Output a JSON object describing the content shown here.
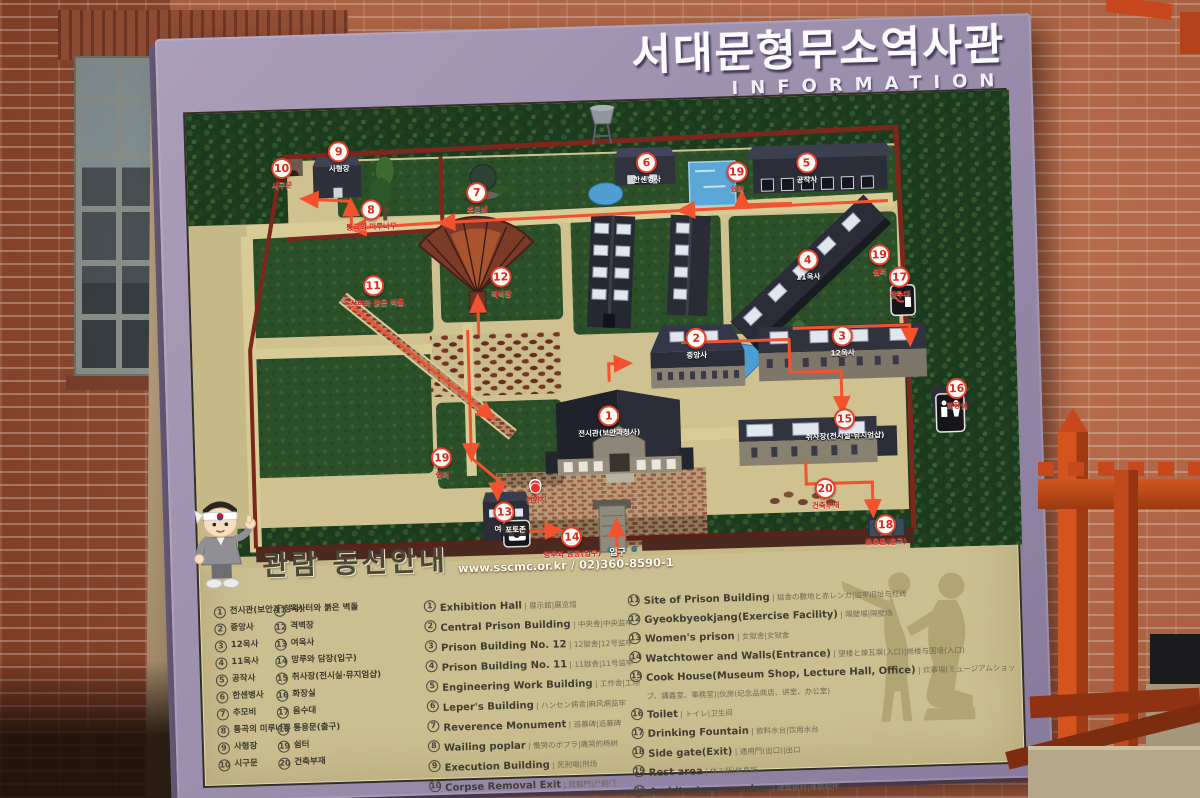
{
  "board": {
    "title_ko": "서대문형무소역사관",
    "title_en": "INFORMATION",
    "guide_title": "관람 동선안내",
    "guide_contact": "www.sscmc.or.kr / 02)360-8590-1"
  },
  "colors": {
    "frame_purple": "#9c8fae",
    "panel_beige": "#cbbe90",
    "route_red": "#f4512e",
    "boundary_wall_red": "#7c261c",
    "tree_green": "#1c3a1e",
    "fence_orange": "#c8481e",
    "marker_ring_red": "#e8402a"
  },
  "map": {
    "markers": [
      {
        "n": "1",
        "label": "전시관(보안과청사)",
        "x": 50.3,
        "y": 70.3,
        "on": "dark"
      },
      {
        "n": "2",
        "label": "중앙사",
        "x": 61.2,
        "y": 53.8,
        "on": "dark"
      },
      {
        "n": "3",
        "label": "12옥사",
        "x": 78.9,
        "y": 54.3,
        "on": "dark"
      },
      {
        "n": "4",
        "label": "11옥사",
        "x": 75.0,
        "y": 37.4,
        "on": "dark"
      },
      {
        "n": "5",
        "label": "공작사",
        "x": 75.2,
        "y": 16.0,
        "on": "dark"
      },
      {
        "n": "6",
        "label": "한센병사",
        "x": 55.8,
        "y": 14.9,
        "on": "dark"
      },
      {
        "n": "7",
        "label": "추모비",
        "x": 35.1,
        "y": 20.4,
        "on": "light"
      },
      {
        "n": "8",
        "label": "통곡의 미루나무",
        "x": 22.2,
        "y": 23.5,
        "on": "light"
      },
      {
        "n": "9",
        "label": "사형장",
        "x": 18.5,
        "y": 10.5,
        "on": "dark"
      },
      {
        "n": "10",
        "label": "시구문",
        "x": 11.5,
        "y": 13.8,
        "on": "light"
      },
      {
        "n": "11",
        "label": "옥사터와 붉은 벽돌",
        "x": 22.2,
        "y": 40.2,
        "on": "light"
      },
      {
        "n": "12",
        "label": "격벽장",
        "x": 37.7,
        "y": 39.1,
        "on": "light"
      },
      {
        "n": "13",
        "label": "여옥사",
        "x": 37.3,
        "y": 90.8,
        "on": "dark"
      },
      {
        "n": "14",
        "label": "망루와 담장(입구)",
        "x": 45.4,
        "y": 96.7,
        "on": "light"
      },
      {
        "n": "15",
        "label": "취사장(전시실·뮤지엄샵)",
        "x": 78.9,
        "y": 72.5,
        "on": "dark"
      },
      {
        "n": "16",
        "label": "화장실",
        "x": 92.6,
        "y": 66.6,
        "on": "light"
      },
      {
        "n": "17",
        "label": "음수대",
        "x": 86.1,
        "y": 41.8,
        "on": "light"
      },
      {
        "n": "18",
        "label": "통용문(출구)",
        "x": 83.5,
        "y": 96.0,
        "on": "light"
      },
      {
        "n": "19",
        "label": "쉼터",
        "x": 66.7,
        "y": 17.6,
        "on": "light"
      },
      {
        "n": "19",
        "label": "쉼터",
        "x": 83.7,
        "y": 36.7,
        "on": "light"
      },
      {
        "n": "19",
        "label": "쉼터",
        "x": 29.9,
        "y": 78.5,
        "on": "light"
      },
      {
        "n": "20",
        "label": "건축부재",
        "x": 76.3,
        "y": 87.7,
        "on": "light"
      }
    ],
    "tags": [
      {
        "label": "현위치",
        "x": 41.2,
        "y": 85.7,
        "type": "dot"
      },
      {
        "label": "포토존",
        "x": 38.6,
        "y": 93.5,
        "type": "photo"
      },
      {
        "label": "입구",
        "x": 50.9,
        "y": 99.0,
        "type": "plain"
      }
    ]
  },
  "legend": {
    "ko_col1": [
      {
        "n": "1",
        "t": "전시관(보안과 청사)"
      },
      {
        "n": "2",
        "t": "중앙사"
      },
      {
        "n": "3",
        "t": "12옥사"
      },
      {
        "n": "4",
        "t": "11옥사"
      },
      {
        "n": "5",
        "t": "공작사"
      },
      {
        "n": "6",
        "t": "한센병사"
      },
      {
        "n": "7",
        "t": "추모비"
      },
      {
        "n": "8",
        "t": "통곡의 미루나무"
      },
      {
        "n": "9",
        "t": "사형장"
      },
      {
        "n": "10",
        "t": "시구문"
      }
    ],
    "ko_col2": [
      {
        "n": "11",
        "t": "옥사터와 붉은 벽돌"
      },
      {
        "n": "12",
        "t": "격벽장"
      },
      {
        "n": "13",
        "t": "여옥사"
      },
      {
        "n": "14",
        "t": "망루와 담장(입구)"
      },
      {
        "n": "15",
        "t": "취사장(전시실·뮤지엄샵)"
      },
      {
        "n": "16",
        "t": "화장실"
      },
      {
        "n": "17",
        "t": "음수대"
      },
      {
        "n": "18",
        "t": "통용문(출구)"
      },
      {
        "n": "19",
        "t": "쉼터"
      },
      {
        "n": "20",
        "t": "건축부재"
      }
    ],
    "en_col1": [
      {
        "n": "1",
        "en": "Exhibition Hall",
        "cjk": "展示館|展览馆"
      },
      {
        "n": "2",
        "en": "Central Prison Building",
        "cjk": "中央舎|中央监牢"
      },
      {
        "n": "3",
        "en": "Prison Building No. 12",
        "cjk": "12獄舎|12号监牢"
      },
      {
        "n": "4",
        "en": "Prison Building No. 11",
        "cjk": "11獄舎|11号监牢"
      },
      {
        "n": "5",
        "en": "Engineering Work Building",
        "cjk": "工作舎|工场"
      },
      {
        "n": "6",
        "en": "Leper's Building",
        "cjk": "ハンセン病舎|麻风病监牢"
      },
      {
        "n": "7",
        "en": "Reverence Monument",
        "cjk": "追慕碑|追慕碑"
      },
      {
        "n": "8",
        "en": "Wailing poplar",
        "cjk": "慟哭のポプラ|痛哭的杨树"
      },
      {
        "n": "9",
        "en": "Execution Building",
        "cjk": "死刑場|刑场"
      },
      {
        "n": "10",
        "en": "Corpse Removal Exit",
        "cjk": "屍軀門|尸躯门"
      }
    ],
    "en_col2": [
      {
        "n": "11",
        "en": "Site of Prison Building",
        "cjk": "獄舎の敷地と赤レンガ|监牢旧址与红砖"
      },
      {
        "n": "12",
        "en": "Gyeokbyeokjang(Exercise Facility)",
        "cjk": "隔壁場|隔壁场"
      },
      {
        "n": "13",
        "en": "Women's prison",
        "cjk": "女獄舎|女狱舍"
      },
      {
        "n": "14",
        "en": "Watchtower and Walls(Entrance)",
        "cjk": "望楼と煉瓦塀(入口)|岗楼与围墙(入口)"
      },
      {
        "n": "15",
        "en": "Cook House(Museum Shop, Lecture Hall, Office)",
        "cjk": "炊事場(ミュージアムショップ、講義室、事務室)|伙房(纪念品商店、讲室、办公室)"
      },
      {
        "n": "16",
        "en": "Toilet",
        "cjk": "トイレ|卫生间"
      },
      {
        "n": "17",
        "en": "Drinking Fountain",
        "cjk": "飲料水台|饮用水台"
      },
      {
        "n": "18",
        "en": "Side gate(Exit)",
        "cjk": "通用門(出口)|出口"
      },
      {
        "n": "19",
        "en": "Rest area",
        "cjk": "休み所|休息所"
      },
      {
        "n": "20",
        "en": "Architecture member",
        "cjk": "建築部材|建築构件"
      }
    ]
  }
}
